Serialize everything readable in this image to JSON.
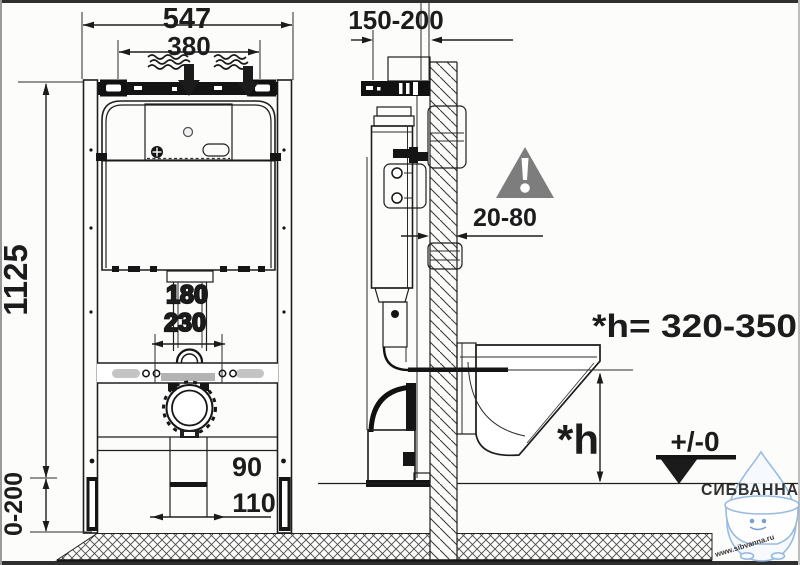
{
  "drawing": {
    "title": "wall-hung toilet installation frame diagram",
    "front_view": {
      "dim_total_width": "547",
      "dim_hanger_width": "380",
      "dim_frame_height": "1125",
      "dim_leg_adjust": "0-200",
      "dim_pipe_offset_a": "180",
      "dim_pipe_offset_b": "230",
      "dim_outlet_height": "90",
      "dim_outlet_diameter": "110"
    },
    "side_view": {
      "dim_mount_depth": "150-200",
      "dim_wall_gap": "20-80",
      "bowl_height_label": "*h",
      "bowl_height_value": "*h= 320-350",
      "floor_level": "+/-0"
    },
    "colors": {
      "line": "#1e1e1e",
      "warning_gray": "#7d7d7d",
      "watermark_blue": "#4a76c9"
    },
    "watermark": {
      "brand": "СИБВАННА",
      "site": "www.sibvanna.ru"
    }
  }
}
